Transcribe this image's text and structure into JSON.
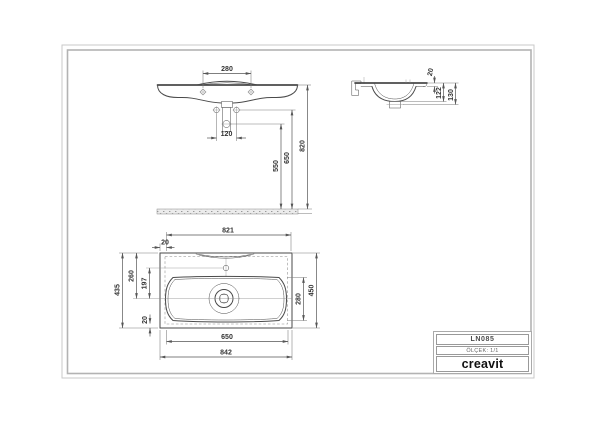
{
  "page": {
    "background": "#ffffff"
  },
  "frame": {
    "outer_color": "#c9c9c9",
    "inner_color": "#b3b3b3"
  },
  "views": {
    "front": {
      "dims": {
        "faucet_centers": "280",
        "drain_width": "120",
        "trap_height": "550",
        "drain_height": "650",
        "rim_height": "820"
      }
    },
    "side": {
      "dims": {
        "edge_thickness": "20",
        "inner_depth": "122",
        "outer_depth": "130"
      }
    },
    "plan": {
      "dims": {
        "inner_width": "821",
        "left_overhang": "20",
        "total_depth": "435",
        "back_to_center": "260",
        "faucet_to_drain": "197",
        "front_overhang": "20",
        "basin_width": "650",
        "total_width": "842",
        "basin_depth": "280",
        "right_depth": "450"
      }
    }
  },
  "title_block": {
    "model_code": "LN085",
    "scale": "ÖLÇEK: 1/1",
    "brand": "creavit"
  }
}
